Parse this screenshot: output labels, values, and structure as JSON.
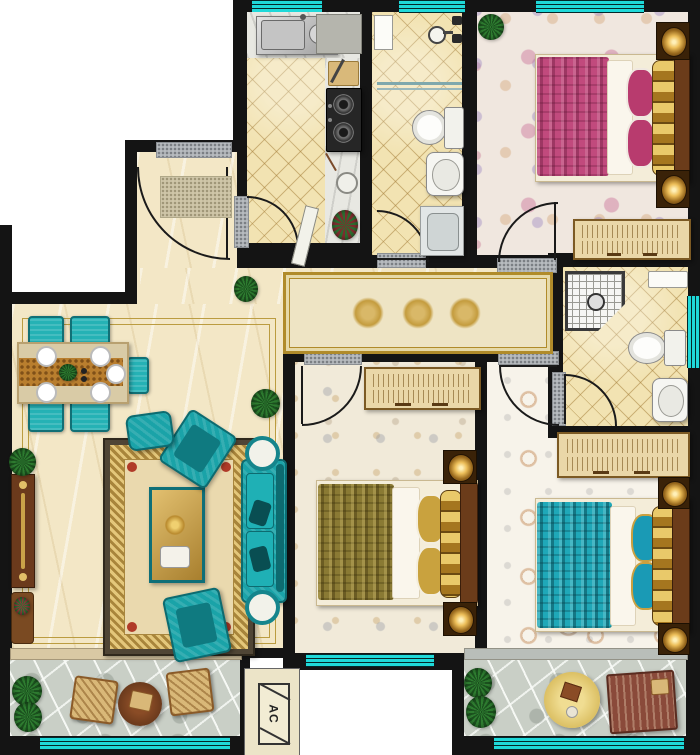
{
  "canvas": {
    "width": 700,
    "height": 755
  },
  "plan_type": "apartment-floor-plan-top-view",
  "text_labels": {
    "ac_unit": "AC"
  },
  "palette": {
    "wall": "#141414",
    "window_teal": "#1fd9d9",
    "tile_floor": "#f2e3b2",
    "marble_floor": "#f3e7c6",
    "stone_floor": "#c9cfc6",
    "teal_furniture": "#1aa3a8",
    "pink_bed": "#c14a7d",
    "gold_bed": "#8a7a34",
    "teal_bed": "#1fa8b8",
    "wood": "#6b3a1c",
    "rug_gold": "#c9a855"
  },
  "rooms": [
    {
      "id": "kitchen",
      "floor": "diamond-tile",
      "items": [
        "double-basin-sink",
        "countertop",
        "cutting-board",
        "two-burner-gas-stove",
        "flower-vase",
        "hinged-door"
      ]
    },
    {
      "id": "bathroom-top",
      "floor": "diamond-tile",
      "items": [
        "storage-cabinet",
        "faucet-valves",
        "towel-rail",
        "toilet",
        "wash-basin",
        "washing-machine",
        "hinged-door"
      ]
    },
    {
      "id": "bedroom-top-right",
      "floor": "pink-floral-carpet",
      "items": [
        "potted-plant",
        "double-bed-pink",
        "nightstand-with-lamp",
        "nightstand-with-lamp",
        "wardrobe",
        "hinged-door"
      ]
    },
    {
      "id": "entry",
      "floor": "marble",
      "items": [
        "entrance-door",
        "doormat",
        "threshold"
      ]
    },
    {
      "id": "hallway",
      "floor": "marble",
      "items": [
        "runner-rug-with-gold-medallions",
        "potted-plant"
      ]
    },
    {
      "id": "living-dining-room",
      "floor": "marble",
      "items": [
        "dining-table-with-place-settings",
        "dining-chair",
        "dining-chair",
        "dining-chair",
        "dining-chair",
        "dining-chair",
        "ornate-area-rug",
        "coffee-table",
        "three-seat-sofa",
        "armchair",
        "armchair",
        "ottoman",
        "round-side-table",
        "round-side-table",
        "console-cabinet",
        "potted-plant",
        "potted-plant",
        "potted-plant"
      ]
    },
    {
      "id": "bathroom-ensuite",
      "floor": "diamond-tile",
      "items": [
        "corner-shower",
        "wall-shelf",
        "toilet",
        "wash-basin",
        "hinged-door"
      ]
    },
    {
      "id": "bedroom-middle",
      "floor": "leaf-pattern-carpet",
      "items": [
        "wardrobe",
        "double-bed-gold",
        "nightstand-with-lamp",
        "nightstand-with-lamp",
        "hinged-door"
      ]
    },
    {
      "id": "bedroom-bottom-right",
      "floor": "swirl-floral-carpet",
      "items": [
        "wardrobe",
        "double-bed-teal",
        "nightstand-with-lamp",
        "nightstand-with-lamp",
        "hinged-door"
      ]
    },
    {
      "id": "balcony-left",
      "floor": "stone-paving",
      "items": [
        "shrubs",
        "wicker-chair",
        "wicker-chair",
        "round-table"
      ]
    },
    {
      "id": "balcony-right",
      "floor": "stone-paving",
      "items": [
        "shrubs",
        "round-table",
        "lounger-mat"
      ]
    },
    {
      "id": "ac-platform",
      "label": "AC",
      "items": [
        "air-conditioner-outdoor-unit"
      ]
    }
  ],
  "windows": [
    {
      "id": "kitchen-top"
    },
    {
      "id": "bathroom-top"
    },
    {
      "id": "bedroom-top-right-top"
    },
    {
      "id": "bathroom-ensuite-right"
    },
    {
      "id": "bedroom-middle-bottom"
    },
    {
      "id": "balcony-left-front"
    },
    {
      "id": "balcony-right-front"
    }
  ]
}
